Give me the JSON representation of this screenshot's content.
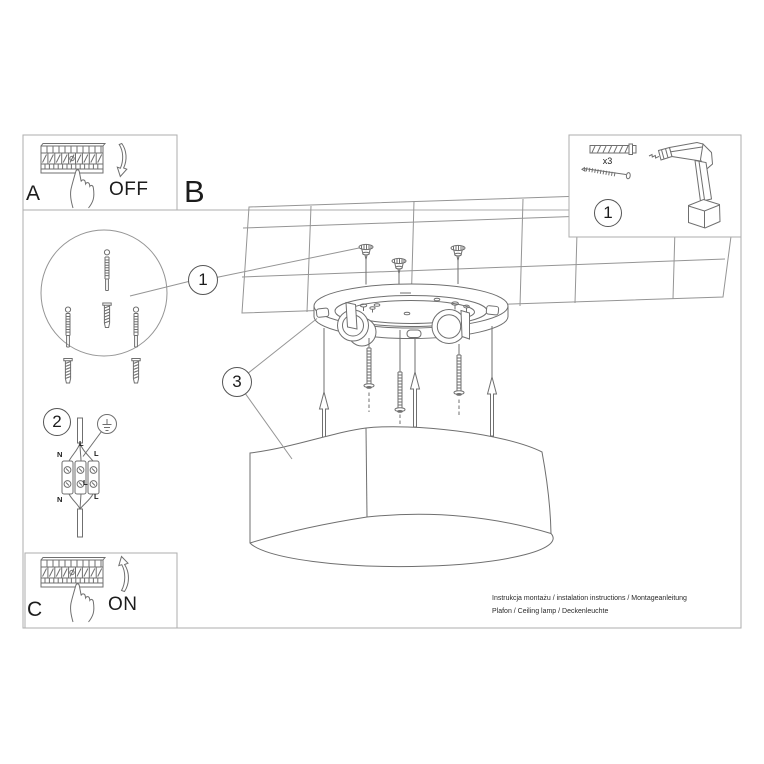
{
  "colors": {
    "border": "#adadad",
    "line": "#6f6f6f",
    "ceiling": "#959595",
    "text": "#1c1c1c"
  },
  "panel_a": {
    "letter": "A",
    "state_label": "OFF"
  },
  "panel_c": {
    "letter": "C",
    "state_label": "ON"
  },
  "section_label": "B",
  "parts_panel": {
    "step_number": "1",
    "anchor_count_label": "x3"
  },
  "callouts": {
    "anchors_step": "1",
    "wiring_step": "2",
    "shade_step": "3"
  },
  "wiring_labels": {
    "top_neutral": "N",
    "top_live": "L",
    "cable_live": "L",
    "center_live": "L",
    "bottom_neutral": "N",
    "bottom_live": "L"
  },
  "footer": {
    "line1": "Instrukcja montażu / instalation instructions / Montageanleitung",
    "line2": "Plafon / Ceiling lamp / Deckenleuchte"
  }
}
